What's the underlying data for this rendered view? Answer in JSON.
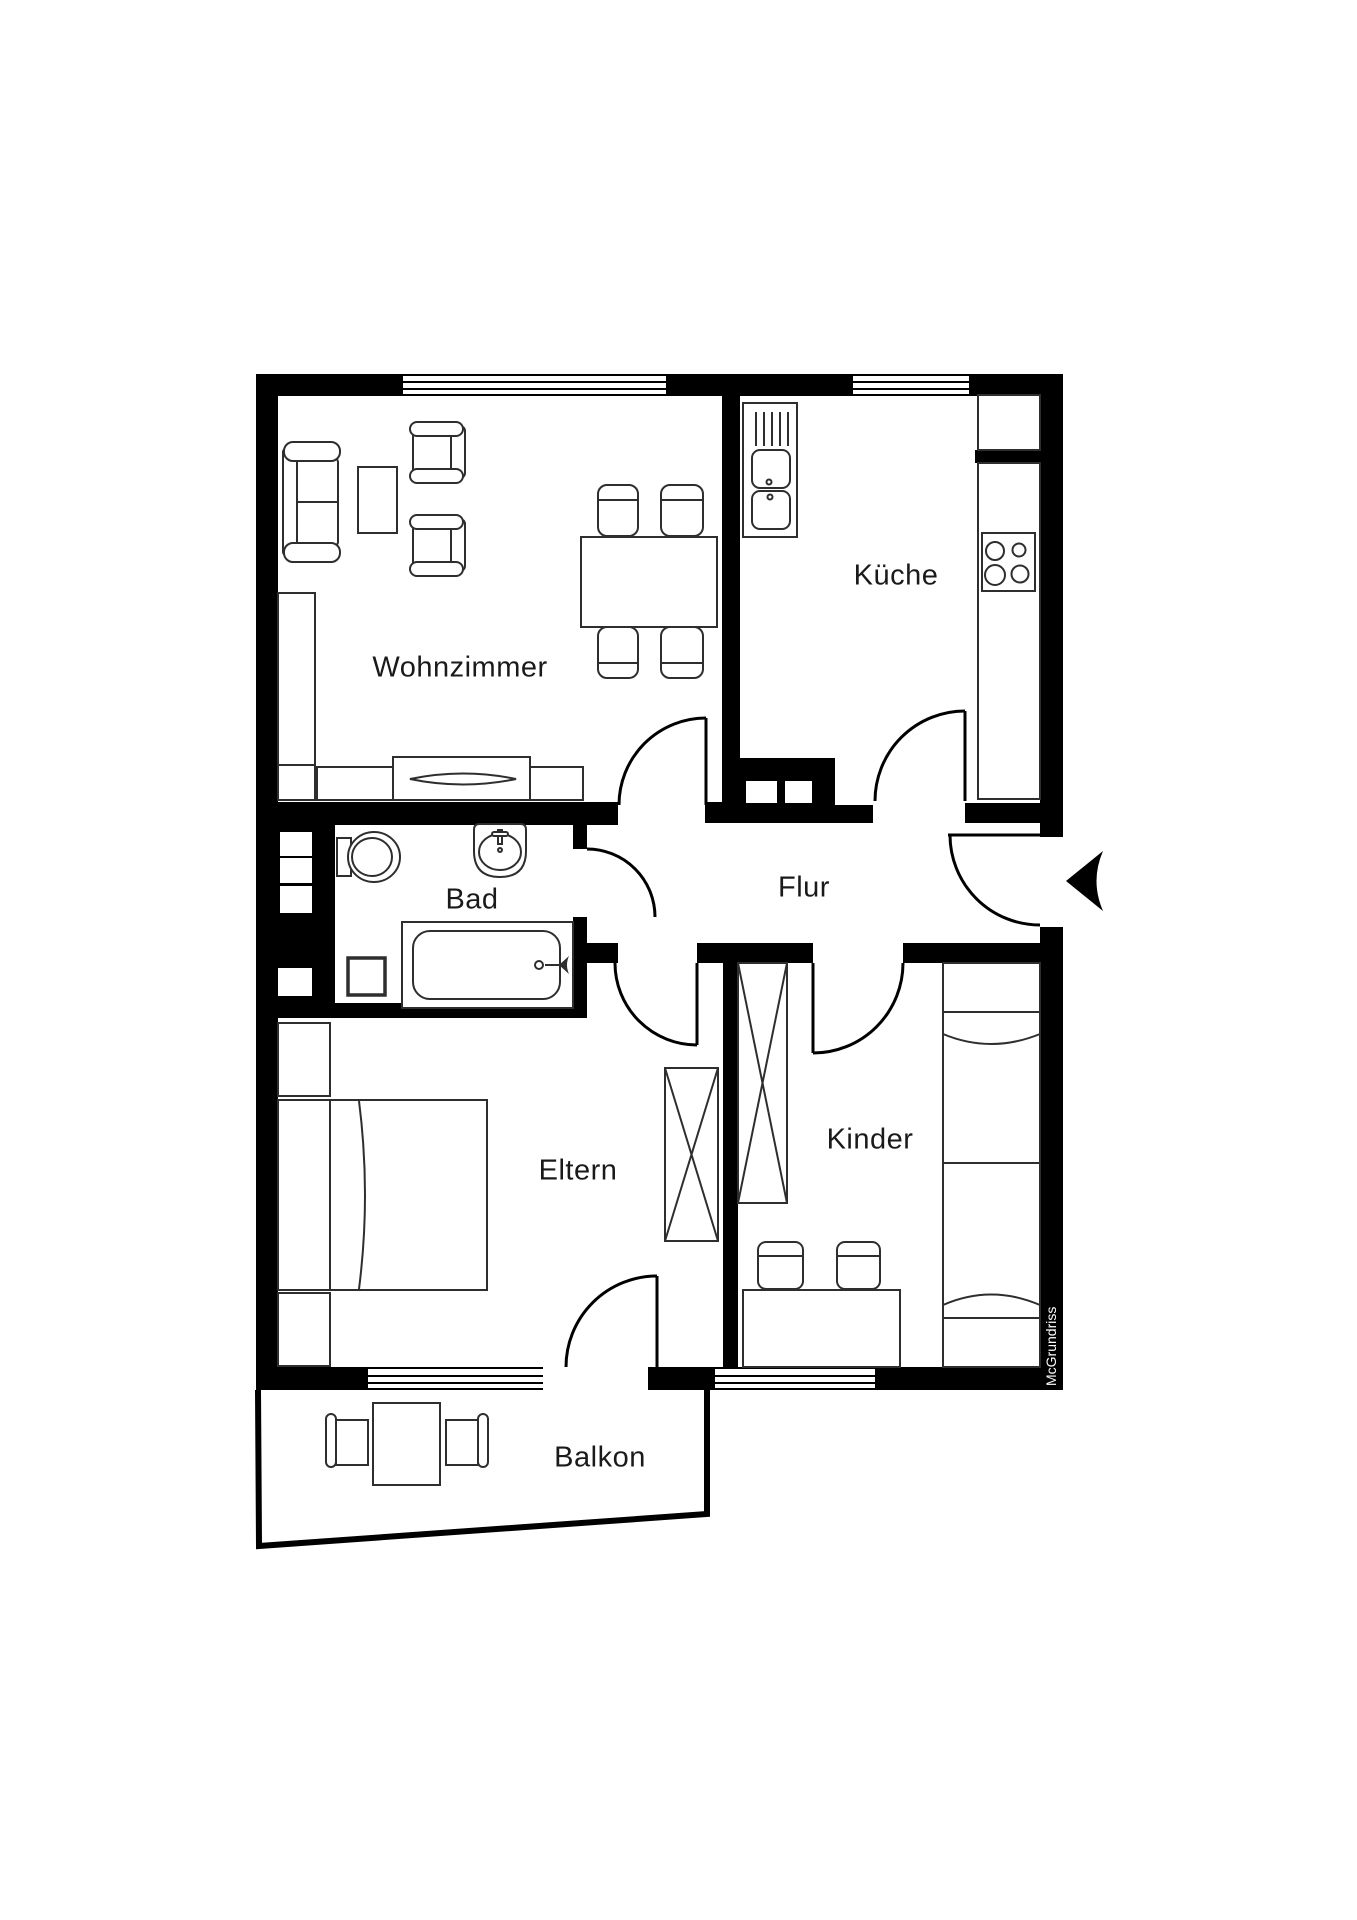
{
  "plan": {
    "rooms": {
      "wohnzimmer": {
        "label": "Wohnzimmer"
      },
      "kueche": {
        "label": "Küche"
      },
      "bad": {
        "label": "Bad"
      },
      "flur": {
        "label": "Flur"
      },
      "eltern": {
        "label": "Eltern"
      },
      "kinder": {
        "label": "Kinder"
      },
      "balkon": {
        "label": "Balkon"
      }
    },
    "watermark": "McGrundriss",
    "colors": {
      "wall": "#000000",
      "furniture_line": "#2e2e2e",
      "background": "#ffffff",
      "label_text": "#1a1a1a",
      "watermark_text": "#ffffff"
    }
  }
}
